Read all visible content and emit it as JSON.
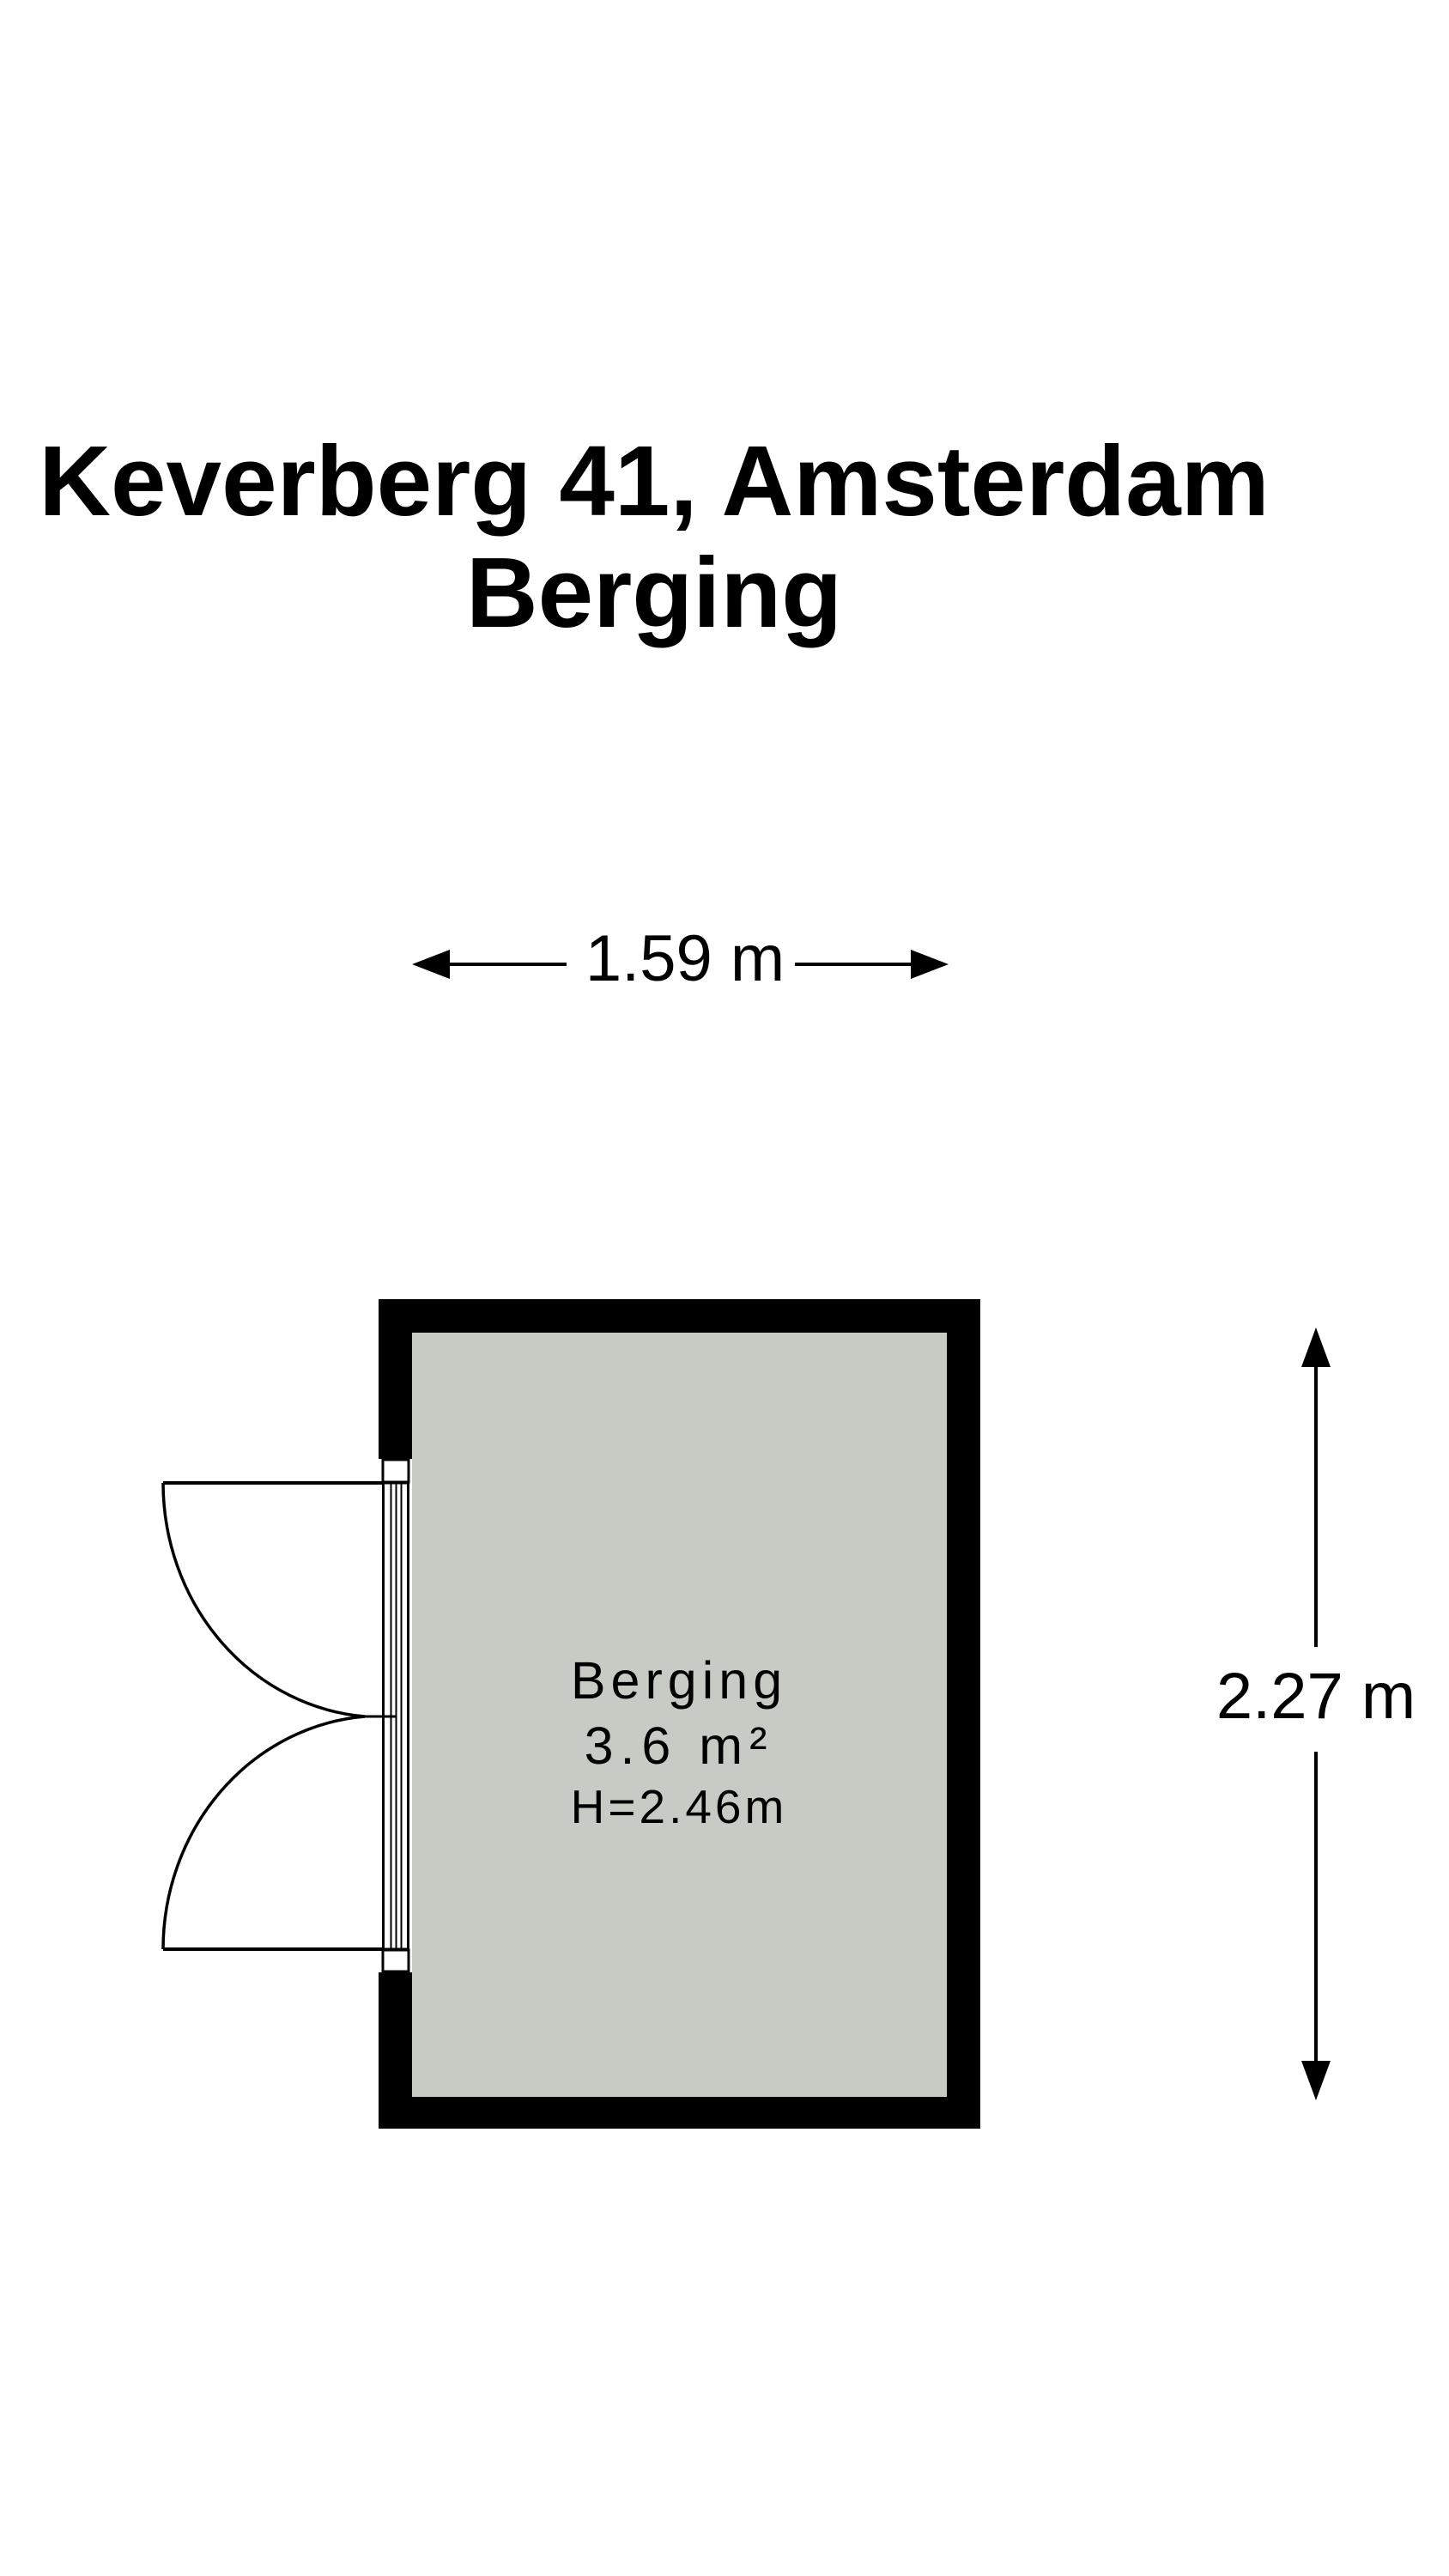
{
  "title": {
    "address": "Keverberg 41, Amsterdam",
    "room": "Berging"
  },
  "dimensions": {
    "width": "1.59 m",
    "height": "2.27 m"
  },
  "room": {
    "name": "Berging",
    "area": "3.6 m²",
    "ceiling_height": "H=2.46m"
  },
  "colors": {
    "wall": "#000000",
    "floor": "#c8cbc4",
    "opening": "#ffffff",
    "line": "#000000"
  }
}
